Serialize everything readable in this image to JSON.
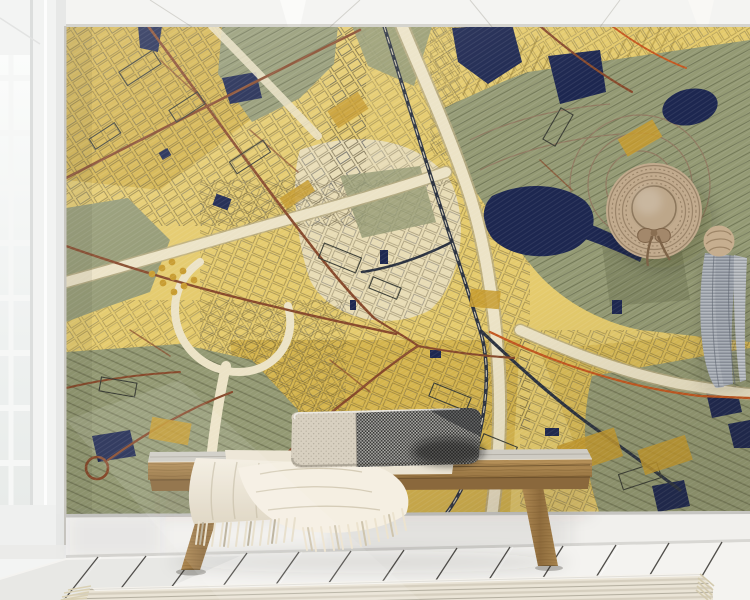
{
  "meta": {
    "kind": "interior-product-mockup-photo",
    "description": "Room mockup photo: gold Klimt-style city map wall mural behind a wooden bench with a two-tone lumbar pillow and fringed throw blanket; straw hat and gray scarf hang on the wall; white plank floor with striped rug; white window at left; white beamed ceiling at top.",
    "width": 750,
    "height": 600
  },
  "scene": {
    "wall_art": {
      "kind": "city-map-mural",
      "style": "gold / olive / navy stylized cartography with cream highways, brown roads and dark railway lines"
    },
    "objects": [
      "ceiling-beams",
      "window",
      "map-mural",
      "straw-hat",
      "hanging-scarf",
      "wooden-bench",
      "lumbar-pillow",
      "throw-blanket",
      "baseboard",
      "plank-floor",
      "striped-rug"
    ]
  },
  "colors": {
    "mapYellow": "#e5cb6d",
    "mapYellowDeep": "#d3b148",
    "mapGold": "#c79b2d",
    "mapPale": "#e9dfc2",
    "mapOlive": "#949a74",
    "mapOliveDark": "#6f7553",
    "mapNavy": "#1d2750",
    "mapCream": "#ece3c6",
    "mapCreamEdge": "#b8ab82",
    "roadBrown": "#86492b",
    "roadOrange": "#c4571f",
    "railDark": "#2b3240",
    "wallWhite": "#f2f1ee",
    "ceilingWhite": "#f4f4f2",
    "baseboard": "#f1f0ed",
    "floorWhite": "#f4f3f0",
    "floorGap": "#34322e",
    "rugBase": "#eae4d6",
    "rugStripe": "#d6cfbf",
    "benchWood": "#ab8751",
    "benchWoodDark": "#8a683c",
    "blanketCream": "#f0e9da",
    "pillowCream": "#d8d0c0",
    "pillowDark": "#4a4a48",
    "hatTan": "#c2ab8e",
    "hatRing": "#8f7960",
    "scarfGray": "#a4a9b1",
    "windowFrame": "#f3f4f3",
    "glass": "#f7f9f8"
  }
}
